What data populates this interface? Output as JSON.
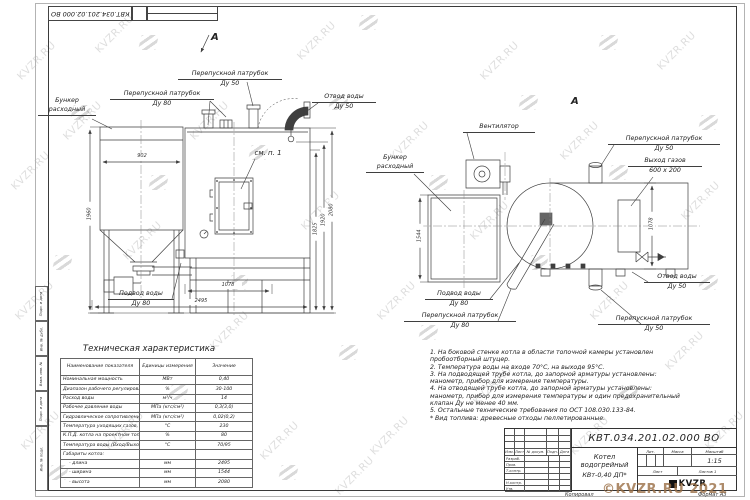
{
  "watermark": {
    "text": "KVZR.RU",
    "copyright": "©KVZR.RU 2021"
  },
  "sheet": {
    "doc_number_top": "КВТ.034.201.02.000 ВО",
    "footer_copy": "Копировал",
    "footer_format": "Формат А3",
    "side_labels": [
      "Подп. и дата",
      "Инв. № дубл.",
      "Взам. инв. №",
      "Подп. и дата",
      "Инв. № подл."
    ]
  },
  "front": {
    "view_letter": "А",
    "labels": {
      "bunker": [
        "Бункер",
        "расходный"
      ],
      "bypass80": [
        "Перепускной патрубок",
        "Ду 80"
      ],
      "bypass50": [
        "Перепускной патрубок",
        "Ду 50"
      ],
      "outlet": [
        "Отвод воды",
        "Ду 50"
      ],
      "see_note": "см. п. 1",
      "inlet": [
        "Подвод воды",
        "Ду 80"
      ]
    },
    "dims": {
      "hopper_width": "902",
      "hopper_height": "1960",
      "pitch": "1078",
      "length": "2495",
      "h1": "1825",
      "h2": "1920",
      "h3": "2080"
    }
  },
  "top": {
    "view_letter": "А",
    "labels": {
      "fan": "Вентилятор",
      "bunker": [
        "Бункер",
        "расходный"
      ],
      "bypass50_top": [
        "Перепускной патрубок",
        "Ду 50"
      ],
      "gas": [
        "Выход газов",
        "600 x 200"
      ],
      "outlet": [
        "Отвод воды",
        "Ду 50"
      ],
      "inlet": [
        "Подвод воды",
        "Ду 80"
      ],
      "bypass80": [
        "Перепускной патрубок",
        "Ду 80"
      ],
      "bypass50_bottom": [
        "Перепускной патрубок",
        "Ду 50"
      ]
    },
    "dims": {
      "width": "1544",
      "pitch": "1078"
    }
  },
  "notes": [
    "1.  На боковой стенке котла в области топочной камеры установлен",
    "пробоотборный штуцер.",
    "2.  Температура воды на входе 70°С, на выходе 95°С.",
    "3.  На подводящей трубе котла, до запорной арматуры установлены:",
    "манометр, прибор для измерения температуры.",
    "4.  На отводящей трубе котла, до запорной арматуры установлены:",
    "манометр, прибор для измерения температуры и один предохранительный",
    "клапан Ду не менее 40 мм.",
    "5.  Остальные технические требования по ОСТ 108.030.133-84.",
    "",
    "*  Вид топлива:  древесные отходы пеллетированные."
  ],
  "spec_table": {
    "title": "Техническая характеристика",
    "headers": [
      "Наименование показателя",
      "Единицы измерения",
      "Значение"
    ],
    "rows": [
      [
        "Номинальная мощность",
        "МВт",
        "0,40"
      ],
      [
        "Диапазон рабочего регулирования",
        "%",
        "30-100"
      ],
      [
        "Расход воды",
        "м³/ч",
        "14"
      ],
      [
        "Рабочее давление воды",
        "МПа (кгс/см²)",
        "0,3(3,0)"
      ],
      [
        "Гидравлическое сопротивление котла",
        "МПа (кгс/см²)",
        "0,02(0,2)"
      ],
      [
        "Температура уходящих газов, не более",
        "°С",
        "230"
      ],
      [
        "К.П.Д. котла на проектном топливе",
        "%",
        "80"
      ],
      [
        "Температура воды (Вход/Выход)",
        "°С",
        "70/95"
      ],
      [
        "Габариты котла:",
        "",
        ""
      ],
      [
        "    - длина",
        "мм",
        "2495"
      ],
      [
        "    - ширина",
        "мм",
        "1544"
      ],
      [
        "    - высота",
        "мм",
        "2080"
      ]
    ]
  },
  "stamp": {
    "doc_number": "КВТ.034.201.02.000 ВО",
    "title_line1": "Котел водогрейный",
    "title_line2": "КВт-0,40  ДП*",
    "header_cols": [
      "Изм.",
      "Лист",
      "№ докум.",
      "Подп.",
      "Дата"
    ],
    "side_rows": [
      "Разраб.",
      "Пров.",
      "Т.контр.",
      "",
      "Н.контр.",
      "Утв."
    ],
    "lit": "Лит.",
    "mass": "Масса",
    "scale": "Масштаб",
    "scale_value": "1:15",
    "sheet": "Лист",
    "sheets": "Листов 1",
    "logo": "KVZR"
  }
}
